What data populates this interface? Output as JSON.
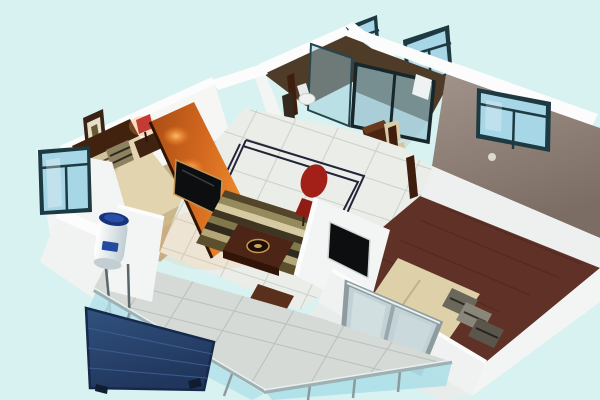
{
  "scene": {
    "title": "3D isometric cutaway floor plan of an apartment",
    "style": "architectural render viewed from above at an angle, walls cut away",
    "rooms": [
      {
        "name": "master-bedroom",
        "position": "top-left",
        "features": [
          "double bed with dark wood headboard",
          "striped pillows",
          "framed picture on back wall",
          "bedside table with red lamp",
          "teal-framed window on left wall",
          "tan carpet floor"
        ]
      },
      {
        "name": "living-room",
        "position": "center",
        "features": [
          "ivory tile floor with dark double-line inlay border",
          "striped area rug",
          "dark wood coffee table with decorative bowl",
          "small wooden stool",
          "red accent chair",
          "orange feature wall with wall-mounted TV and warm spotlights"
        ]
      },
      {
        "name": "bathroom",
        "position": "top-center",
        "features": [
          "dark wood-tone floor",
          "toilet",
          "glass shower partition",
          "teal-framed window above wall"
        ]
      },
      {
        "name": "kitchen",
        "position": "top-center-right",
        "features": [
          "dark brown floor",
          "pale tile near entry",
          "dark-framed glass sliding door",
          "teal-framed window",
          "wooden counter",
          "two beige dining chairs"
        ]
      },
      {
        "name": "second-bedroom",
        "position": "right",
        "features": [
          "taupe feature wall with window and round wall clock",
          "dark maroon wood floor",
          "double bed with beige mattress",
          "gray striped pillows",
          "wall-mounted TV",
          "tilted gray-framed casement window at front"
        ]
      },
      {
        "name": "balcony",
        "position": "bottom-left",
        "features": [
          "gray tile floor",
          "glass railing with gray posts",
          "solar water-heater tank on metal stand",
          "navy solar collector panel hanging over railing edge"
        ]
      }
    ],
    "palette": {
      "background": "#d7f2f1",
      "wall_white": "#f3f5f4",
      "wall_bright": "#fbfcfb",
      "wall_shadow": "#e2e7e6",
      "orange_wall": "#c65f1d",
      "orange_glow": "#ff9e3e",
      "wood_dark": "#4e3b28",
      "door_post": "#3f1e0e",
      "floor_maroon": "#5f3127",
      "tile_ivory": "#eaede8",
      "tile_grout": "#c8cec8",
      "inlay_dark": "#23233a",
      "balcony_tile": "#d5dad7",
      "balcony_grout": "#b9bfbc",
      "glass_blue": "#a7d6e6",
      "glass_frame_teal": "#1d3a42",
      "railing_glass": "#b5e2ea",
      "railing_frame": "#8d9a9c",
      "solar_panel_navy": "#2c4a78",
      "heater_cap_blue": "#16337e",
      "mattress_beige": "#e2d4ae",
      "headboard_brown": "#40220f",
      "carpet_tan": "#c4ad85",
      "red_chair": "#a32019",
      "tv_black": "#0d0e10",
      "tv_frame_gold": "#c49552",
      "counter_wood": "#4c2412",
      "chair_beige": "#d9cca6",
      "taupe_wall": "#8d7e76",
      "clock_face": "#ded9cc",
      "window_unit_glass": "#c2d2d6",
      "window_unit_frame": "#8e9ca0",
      "rug_stripes": [
        "#53452a",
        "#958a5c",
        "#d6caa2",
        "#3e3522",
        "#80784a",
        "#2f2a1c",
        "#b3a678",
        "#5c4f2e"
      ]
    }
  }
}
